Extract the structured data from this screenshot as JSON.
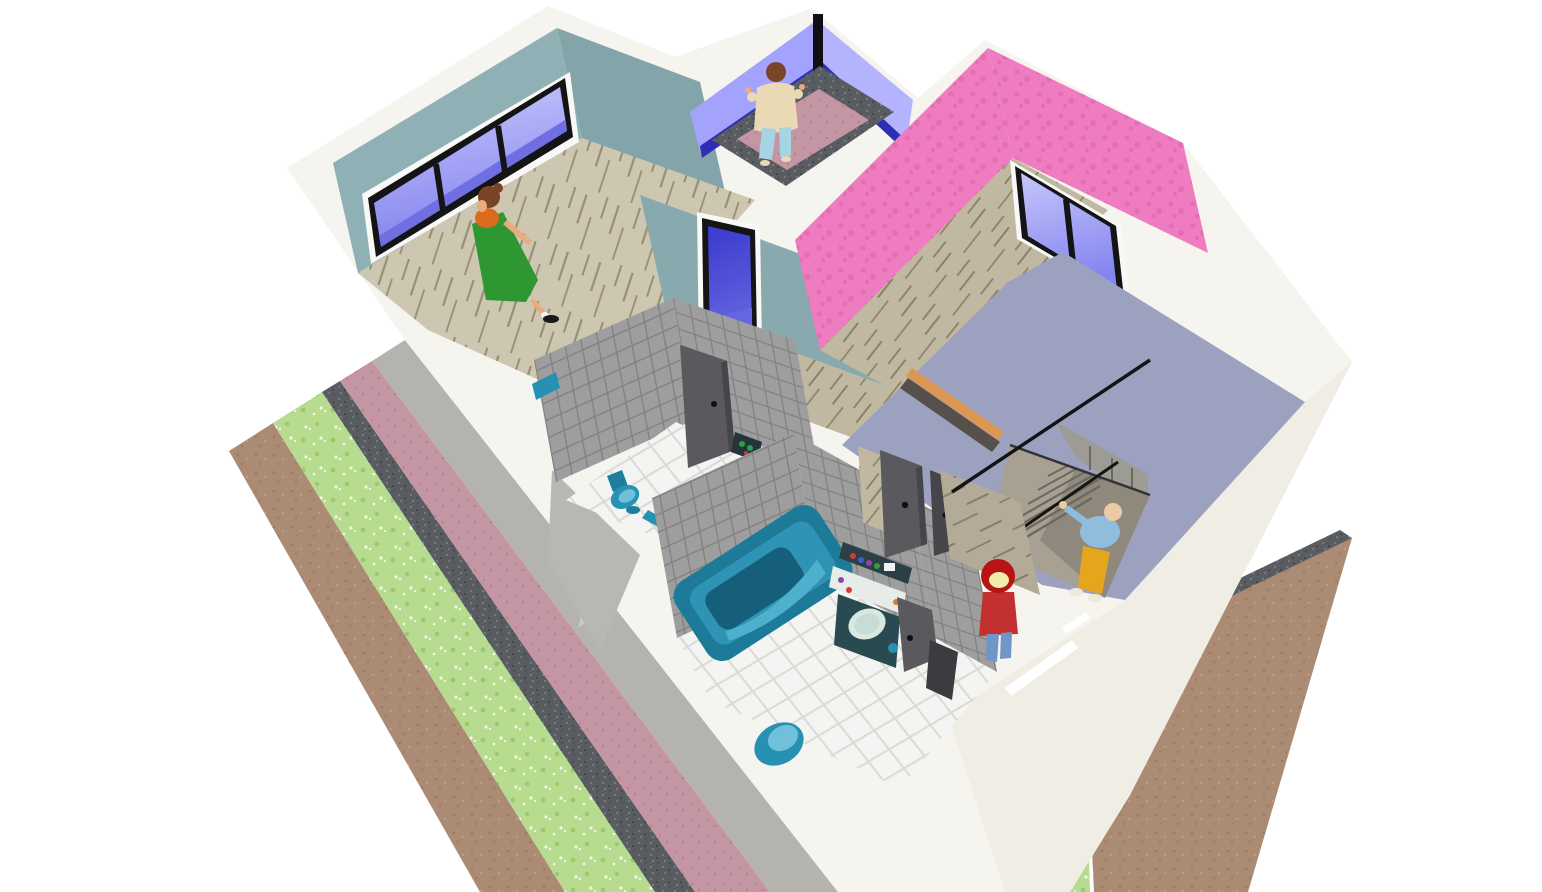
{
  "app": {
    "name": "home-3d-aerial-render",
    "view": "3d-floorplan-overview"
  },
  "palette": {
    "bg": "#ffffff",
    "wall_base": "#f6f4ee",
    "wall_shade_se": "#f0ede4",
    "wall_shadow_gray": "#b9b7b1",
    "concrete": "#b5b3ad",
    "concrete_light": "#cbc9c4",
    "teal_wall_nw": "#8fb0b4",
    "teal_wall_ne": "#83a5aa",
    "teal_wall_corridor": "#88aaaf",
    "peri_wall": "#a3a3fd",
    "peri_wall_light": "#b4b4fe",
    "peri_base_navy": "#2f2fb4",
    "post_black": "#101014",
    "pink_wall": "#ef7cc1",
    "pink_wall_blotch": "#e46db4",
    "lavender": "#9ca1c0",
    "window_trim": "#f8f8f6",
    "window_frame": "#141416",
    "glass_light": "#c6c6fb",
    "glass_mid": "#8585f0",
    "glass_dark": "#6f6fe2",
    "door_blue_top": "#3a3ace",
    "door_blue_bot": "#6666e0",
    "door_gray": "#5a5a5e",
    "door_gray_dark": "#46464a",
    "wood_light": "#cdc6b0",
    "wood_streak": "#978e74",
    "wood_mid": "#c0b8a0",
    "wood_dark_streak": "#8a8168",
    "landing_wood": "#b3ab97",
    "landing_streak": "#847c66",
    "tile_gray": "#9e9e9e",
    "tile_grout": "#818181",
    "floor_tile_white": "#f4f4f2",
    "floor_tile_grout": "#d9d9d6",
    "stairs_tread": "#a9a094",
    "stairs_line": "#6e685e",
    "stairs_edge": "#333333",
    "stairs_deep": "#8f897d",
    "stairs_farwall": "#9c9b94",
    "railing_black": "#141414",
    "threshold_orange": "#dd9752",
    "threshold_dark": "#55504a",
    "grass": "#b7db8f",
    "grass_dot": "#f2f8e6",
    "grass_dot2": "#9cc873",
    "dirt": "#ac8b74",
    "dirt_dot": "#9a7a64",
    "dirt_dot2": "#bd9c85",
    "gravel": "#595d61",
    "gravel_dot": "#7a7e82",
    "gravel_dot2": "#3e4246",
    "mauve_path": "#c495a2",
    "mauve_dot": "#b2848f",
    "tub_body": "#1e7a99",
    "tub_rim": "#2e93b5",
    "tub_inner": "#155f7a",
    "tub_highlight": "#4fb0ce",
    "toilet_body": "#2a93b4",
    "toilet_seat": "#6fc0d8",
    "toilet_dark": "#1e7e9e",
    "teal_fixture": "#2791b3",
    "vanity_cabinet": "#294a50",
    "vanity_counter": "#e8ece9",
    "vanity_backsplash": "#2b3f45",
    "basin_outer": "#dae8e2",
    "basin_inner": "#c6dcd4",
    "basin_rim": "#9fb5ac",
    "shelf_dark": "#24343a",
    "item_red": "#d23b3b",
    "item_blue": "#3e5fd0",
    "item_purple": "#8e44ad",
    "item_green": "#2f9e44",
    "item_orange": "#e07a2a",
    "item_white": "#f2f2f2",
    "dark_opening": "#3c3c40",
    "skin": "#e8ac80",
    "skin_light": "#eacba4",
    "hair_brown": "#7a4526",
    "dress_green": "#2e9732",
    "top_orange": "#d96a1e",
    "shoe_black": "#1a1a1c",
    "sock_white": "#f4f4f4",
    "kid_jacket": "#e9d9b5",
    "kid_pants": "#a5d5e2",
    "hood_red": "#b81414",
    "hood_face": "#f2ecac",
    "body_red": "#c23030",
    "jeans_blue": "#6e96c8",
    "man_shirt": "#90bcdd",
    "man_pants": "#e5a61e",
    "man_shoe": "#efe8dc"
  },
  "scene": {
    "type": "3d-house-aerial-cutaway",
    "rooms": [
      {
        "name": "teal-room",
        "wall_color_key": "teal_wall_nw",
        "floor": "wood",
        "features": [
          "triple-pane-window"
        ]
      },
      {
        "name": "balcony",
        "wall_color_key": "peri_wall",
        "floor": "mauve-with-gravel-border"
      },
      {
        "name": "pink-room",
        "wall_color_key": "pink_wall",
        "floor": "wood",
        "features": [
          "double-pane-window"
        ]
      },
      {
        "name": "entry-hall",
        "wall_color_key": "lavender",
        "floor": "lavender",
        "features": [
          "staircase",
          "railing",
          "orange-threshold",
          "two-gray-doors"
        ]
      },
      {
        "name": "wc",
        "wall_color_key": "tile_gray",
        "floor": "white-tile",
        "features": [
          "teal-toilet",
          "open-door",
          "shelf"
        ]
      },
      {
        "name": "bathroom",
        "wall_color_key": "tile_gray",
        "floor": "white-tile",
        "features": [
          "teal-bathtub",
          "vanity-sink",
          "teal-stool",
          "door"
        ]
      },
      {
        "name": "corridor",
        "wall_color_key": "teal_wall_corridor",
        "floor": "wood",
        "features": [
          "blue-glazed-door"
        ]
      }
    ],
    "people": [
      {
        "name": "woman-green-dress",
        "location": "teal-room"
      },
      {
        "name": "child-beige-jacket",
        "location": "balcony"
      },
      {
        "name": "person-red-hood",
        "location": "stair-landing"
      },
      {
        "name": "man-blue-shirt-yellow-pants",
        "location": "staircase"
      }
    ],
    "exterior": [
      {
        "name": "concrete-apron"
      },
      {
        "name": "mauve-path"
      },
      {
        "name": "gravel-strip"
      },
      {
        "name": "flower-lawn"
      },
      {
        "name": "dirt-border"
      }
    ]
  }
}
